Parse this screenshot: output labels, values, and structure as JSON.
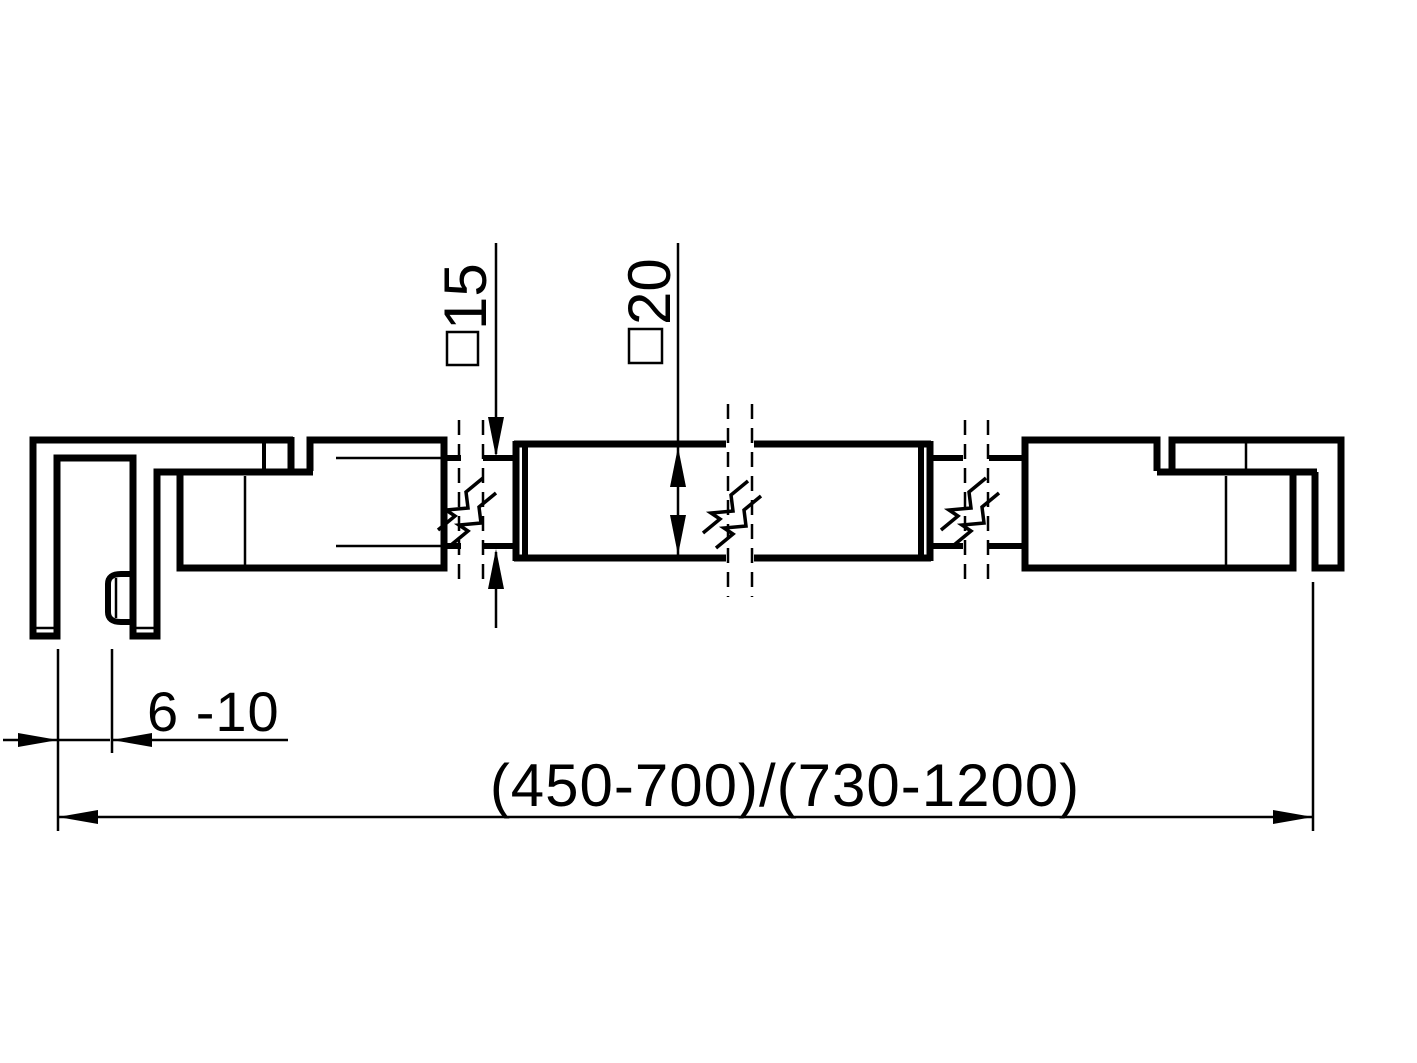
{
  "drawing": {
    "dimensions": {
      "small_bar_profile_value": "15",
      "large_bar_profile_value": "20",
      "profile_symbol": "□",
      "glass_thickness_range": "6 -10",
      "overall_length_range": "(450-700)/(730-1200)"
    },
    "colors": {
      "line": "#000000",
      "background": "#ffffff"
    }
  }
}
